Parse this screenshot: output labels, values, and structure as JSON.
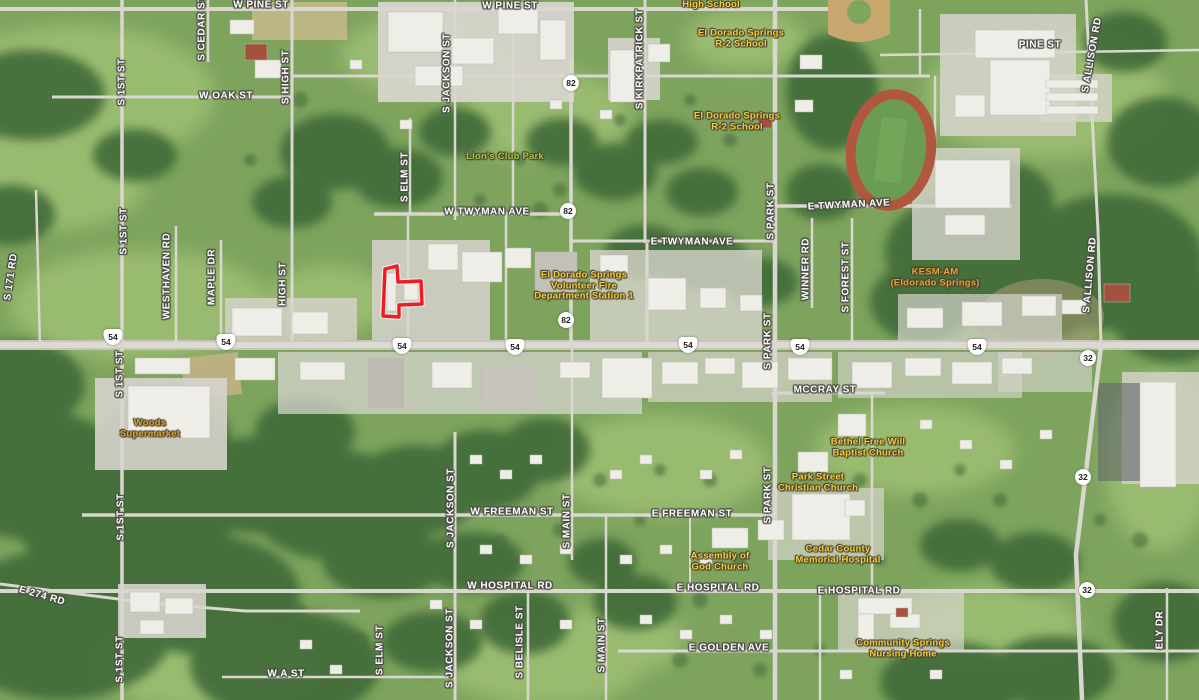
{
  "streets_horizontal": [
    {
      "label": "W PINE ST",
      "x": 261,
      "y": 5
    },
    {
      "label": "W PINE ST",
      "x": 510,
      "y": 6
    },
    {
      "label": "PINE ST",
      "x": 1040,
      "y": 45
    },
    {
      "label": "W OAK ST",
      "x": 226,
      "y": 96
    },
    {
      "label": "W TWYMAN AVE",
      "x": 487,
      "y": 212
    },
    {
      "label": "E TWYMAN AVE",
      "x": 849,
      "y": 205,
      "rot": -3
    },
    {
      "label": "E TWYMAN AVE",
      "x": 692,
      "y": 242
    },
    {
      "label": "MCCRAY ST",
      "x": 825,
      "y": 390
    },
    {
      "label": "W FREEMAN ST",
      "x": 512,
      "y": 512
    },
    {
      "label": "E FREEMAN ST",
      "x": 692,
      "y": 514
    },
    {
      "label": "W HOSPITAL RD",
      "x": 510,
      "y": 586
    },
    {
      "label": "E HOSPITAL RD",
      "x": 718,
      "y": 588
    },
    {
      "label": "E HOSPITAL RD",
      "x": 859,
      "y": 591
    },
    {
      "label": "E GOLDEN AVE",
      "x": 729,
      "y": 648
    },
    {
      "label": "W A ST",
      "x": 286,
      "y": 674
    },
    {
      "label": "E 274 RD",
      "x": 42,
      "y": 596,
      "rot": 16
    }
  ],
  "streets_vertical": [
    {
      "label": "S CEDAR ST",
      "x": 202,
      "y": 28
    },
    {
      "label": "S 1ST ST",
      "x": 122,
      "y": 82
    },
    {
      "label": "S HIGH ST",
      "x": 286,
      "y": 77
    },
    {
      "label": "S JACKSON ST",
      "x": 447,
      "y": 73
    },
    {
      "label": "S KIRKPATRICK ST",
      "x": 640,
      "y": 59
    },
    {
      "label": "S ALLISON RD",
      "x": 1092,
      "y": 55,
      "rot": -80
    },
    {
      "label": "S ELM ST",
      "x": 405,
      "y": 177
    },
    {
      "label": "S 1ST ST",
      "x": 124,
      "y": 231
    },
    {
      "label": "WESTHAVEN RD",
      "x": 167,
      "y": 276
    },
    {
      "label": "MAPLE DR",
      "x": 212,
      "y": 277
    },
    {
      "label": "HIGH ST",
      "x": 283,
      "y": 284
    },
    {
      "label": "S 171 RD",
      "x": 11,
      "y": 277,
      "rot": -82
    },
    {
      "label": "S PARK ST",
      "x": 771,
      "y": 211
    },
    {
      "label": "WINNER RD",
      "x": 806,
      "y": 269
    },
    {
      "label": "S FOREST ST",
      "x": 846,
      "y": 277
    },
    {
      "label": "S ALLISON RD",
      "x": 1090,
      "y": 275,
      "rot": -85
    },
    {
      "label": "S 1ST ST",
      "x": 120,
      "y": 374
    },
    {
      "label": "S PARK ST",
      "x": 768,
      "y": 341
    },
    {
      "label": "S JACKSON ST",
      "x": 451,
      "y": 508
    },
    {
      "label": "S MAIN ST",
      "x": 567,
      "y": 521
    },
    {
      "label": "S PARK ST",
      "x": 768,
      "y": 495
    },
    {
      "label": "S 1ST ST",
      "x": 121,
      "y": 517
    },
    {
      "label": "S 1ST ST",
      "x": 120,
      "y": 659
    },
    {
      "label": "S ELM ST",
      "x": 380,
      "y": 650
    },
    {
      "label": "S JACKSON ST",
      "x": 450,
      "y": 648
    },
    {
      "label": "S BELISLE ST",
      "x": 520,
      "y": 642
    },
    {
      "label": "S MAIN ST",
      "x": 602,
      "y": 645
    },
    {
      "label": "ELY DR",
      "x": 1160,
      "y": 630
    }
  ],
  "pois": [
    {
      "lines": [
        "High School"
      ],
      "x": 711,
      "y": 5,
      "color": "yellow"
    },
    {
      "lines": [
        "El Dorado Springs",
        "R-2 School"
      ],
      "x": 741,
      "y": 39,
      "color": "yellow"
    },
    {
      "lines": [
        "El Dorado Springs",
        "R-2 School"
      ],
      "x": 737,
      "y": 122,
      "color": "yellow"
    },
    {
      "lines": [
        "Lion's Club Park"
      ],
      "x": 505,
      "y": 157,
      "color": "green"
    },
    {
      "lines": [
        "El Dorado Springs",
        "Volunteer Fire",
        "Department Station 1"
      ],
      "x": 584,
      "y": 286,
      "color": "yellow"
    },
    {
      "lines": [
        "KESM-AM",
        "(Eldorado Springs)"
      ],
      "x": 935,
      "y": 278,
      "color": "orange"
    },
    {
      "lines": [
        "Woods",
        "Supermarket"
      ],
      "x": 150,
      "y": 429,
      "color": "orange"
    },
    {
      "lines": [
        "Bethel Free Will",
        "Baptist Church"
      ],
      "x": 868,
      "y": 448,
      "color": "yellow"
    },
    {
      "lines": [
        "Park Street",
        "Christian Church"
      ],
      "x": 818,
      "y": 483,
      "color": "yellow"
    },
    {
      "lines": [
        "Assembly of",
        "God Church"
      ],
      "x": 720,
      "y": 562,
      "color": "yellow"
    },
    {
      "lines": [
        "Cedar County",
        "Memorial Hospital"
      ],
      "x": 838,
      "y": 555,
      "color": "yellow"
    },
    {
      "lines": [
        "Community Springs",
        "Nursing Home"
      ],
      "x": 903,
      "y": 649,
      "color": "yellow"
    }
  ],
  "shields": [
    {
      "type": "us",
      "label": "54",
      "x": 113,
      "y": 337
    },
    {
      "type": "us",
      "label": "54",
      "x": 226,
      "y": 342
    },
    {
      "type": "us",
      "label": "54",
      "x": 402,
      "y": 346
    },
    {
      "type": "us",
      "label": "54",
      "x": 515,
      "y": 347
    },
    {
      "type": "us",
      "label": "54",
      "x": 688,
      "y": 345
    },
    {
      "type": "us",
      "label": "54",
      "x": 800,
      "y": 347
    },
    {
      "type": "us",
      "label": "54",
      "x": 977,
      "y": 347
    },
    {
      "type": "circle",
      "label": "82",
      "x": 571,
      "y": 83
    },
    {
      "type": "circle",
      "label": "82",
      "x": 568,
      "y": 211
    },
    {
      "type": "circle",
      "label": "82",
      "x": 566,
      "y": 320
    },
    {
      "type": "circle",
      "label": "32",
      "x": 1088,
      "y": 358
    },
    {
      "type": "circle",
      "label": "32",
      "x": 1083,
      "y": 477
    },
    {
      "type": "circle",
      "label": "32",
      "x": 1087,
      "y": 590
    }
  ],
  "parcel": {
    "points": "385,269 397,266 398,282 421,281 422,304 399,305 399,317 383,316",
    "outline_color": "#ee1c25"
  },
  "colors": {
    "street_label": "#ffffff",
    "poi_yellow": "#f3ce3e",
    "poi_orange": "#e3a233",
    "park_green": "#a9c64a",
    "shield_text": "#1d1d1b"
  }
}
